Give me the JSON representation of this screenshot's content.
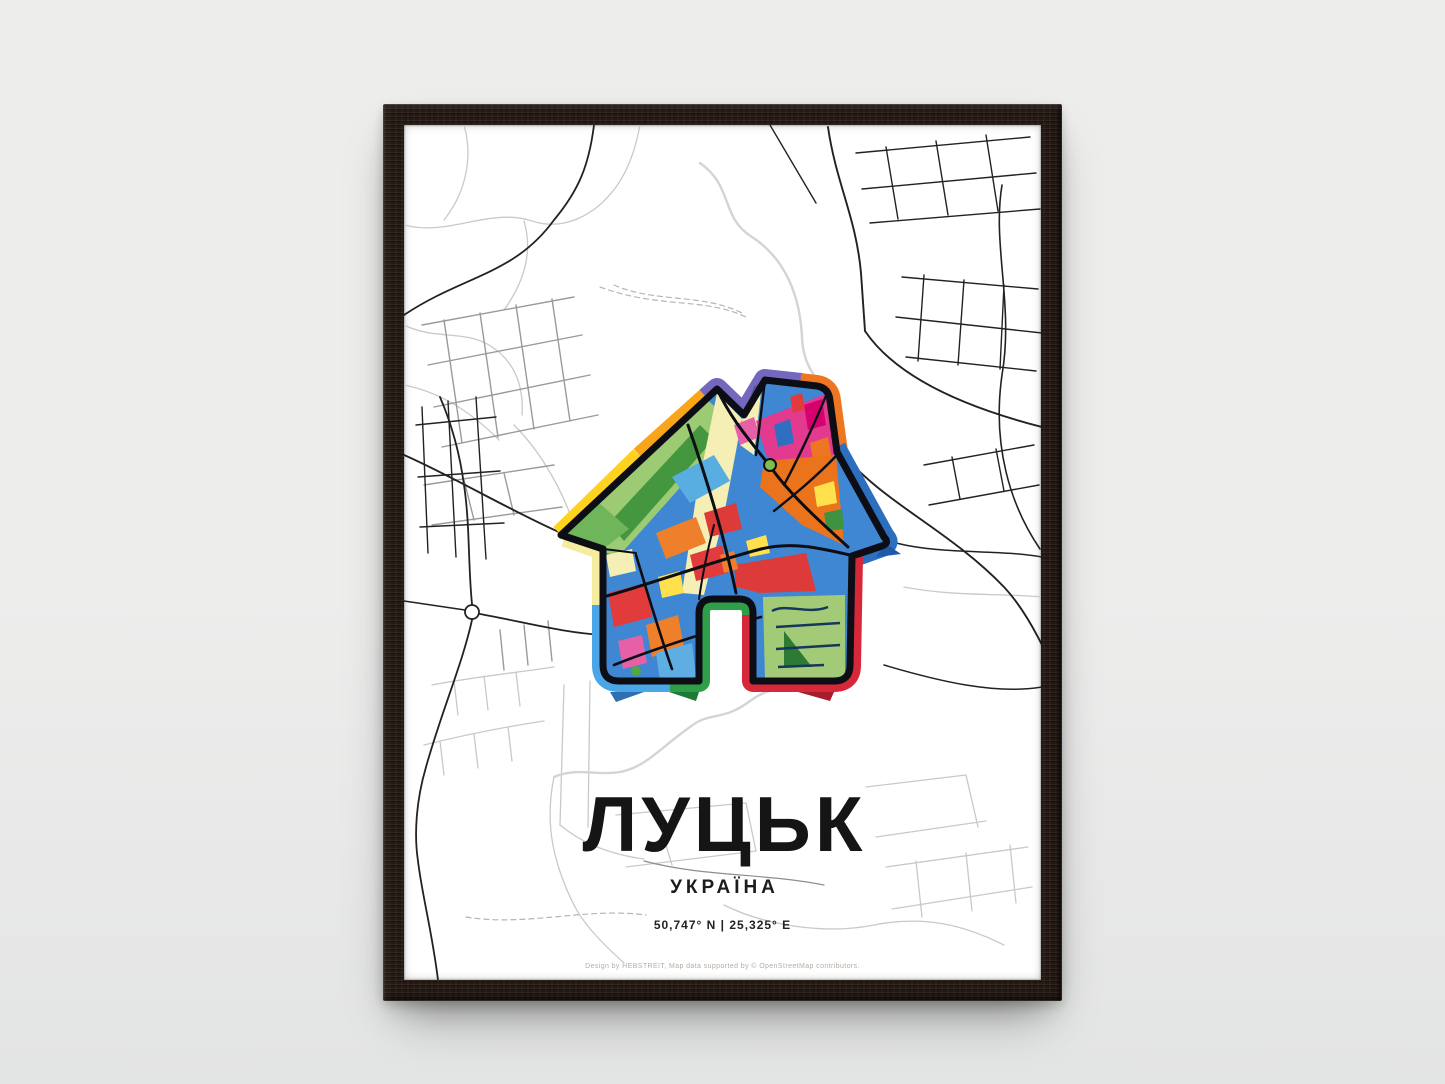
{
  "poster": {
    "title": "ЛУЦЬК",
    "subtitle": "УКРАЇНА",
    "coordinates": "50,747° N | 25,325° E",
    "credit": "Design by HEBSTREIT, Map data supported by © OpenStreetMap contributors."
  },
  "artwork": {
    "type": "framed city map poster",
    "city": "ЛУЦЬК",
    "country": "УКРАЇНА",
    "latitude": "50,747° N",
    "longitude": "25,325° E",
    "house_band_colors": [
      "#FFD21F",
      "#F9A51A",
      "#7368BD",
      "#EE7623",
      "#2C6FBE",
      "#D62839",
      "#2E9E49",
      "#4BA6E8",
      "#F6ECA0"
    ],
    "mosaic_colors": [
      "#3F87D2",
      "#E23A8E",
      "#EA731C",
      "#DD3A3A",
      "#F5EFB5",
      "#A3CB77",
      "#45973F",
      "#FFE14E",
      "#E660A8"
    ]
  },
  "palette": {
    "wall": "#ededec",
    "wall-deep": "#e3e4e4",
    "frame": "#231812",
    "ink": "#151515",
    "credit": "#b5aca3"
  }
}
